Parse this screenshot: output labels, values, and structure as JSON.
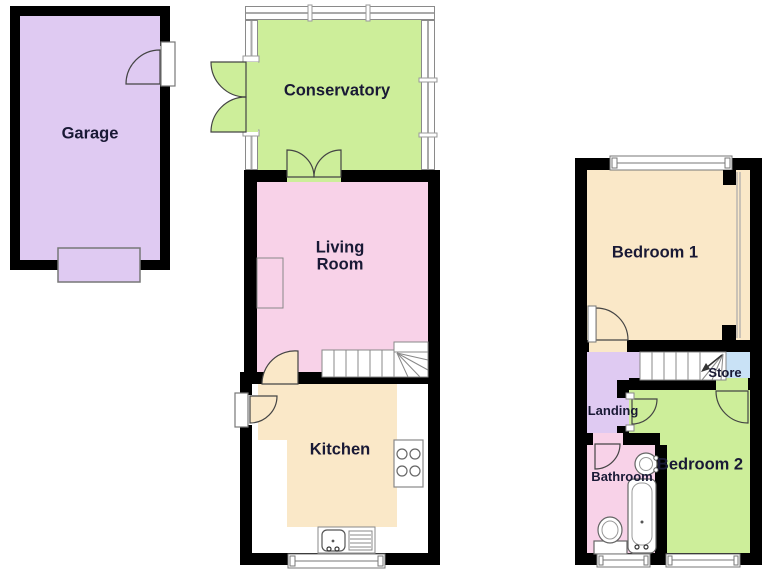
{
  "labels": {
    "garage": "Garage",
    "conservatory": "Conservatory",
    "living_room": "Living Room",
    "kitchen": "Kitchen",
    "bedroom1": "Bedroom 1",
    "bedroom2": "Bedroom 2",
    "landing": "Landing",
    "bathroom": "Bathroom",
    "store": "Store"
  },
  "floors": {
    "ground": {
      "rooms": [
        "Garage",
        "Conservatory",
        "Living Room",
        "Kitchen"
      ]
    },
    "first": {
      "rooms": [
        "Bedroom 1",
        "Landing",
        "Store",
        "Bedroom 2",
        "Bathroom"
      ]
    }
  },
  "colors": {
    "wall": "#000000",
    "garage": "#dfcaf2",
    "landing": "#dfcaf2",
    "conservatory": "#cdee9a",
    "bedroom2": "#cdee9a",
    "living_room": "#f8d2e8",
    "bathroom": "#f8d2e8",
    "bedroom1": "#fae8c8",
    "kitchen_floor": "#fae8c8",
    "store": "#c9e2f6",
    "counters": "#ffffff"
  },
  "icons": [
    "door-arc",
    "double-door-arc",
    "window",
    "staircase",
    "stairs-direction-arrow",
    "garage-entry-door",
    "bath",
    "toilet",
    "sink",
    "hob",
    "kitchen-sink",
    "drainer",
    "wardrobe-partition",
    "chimney-recess"
  ]
}
